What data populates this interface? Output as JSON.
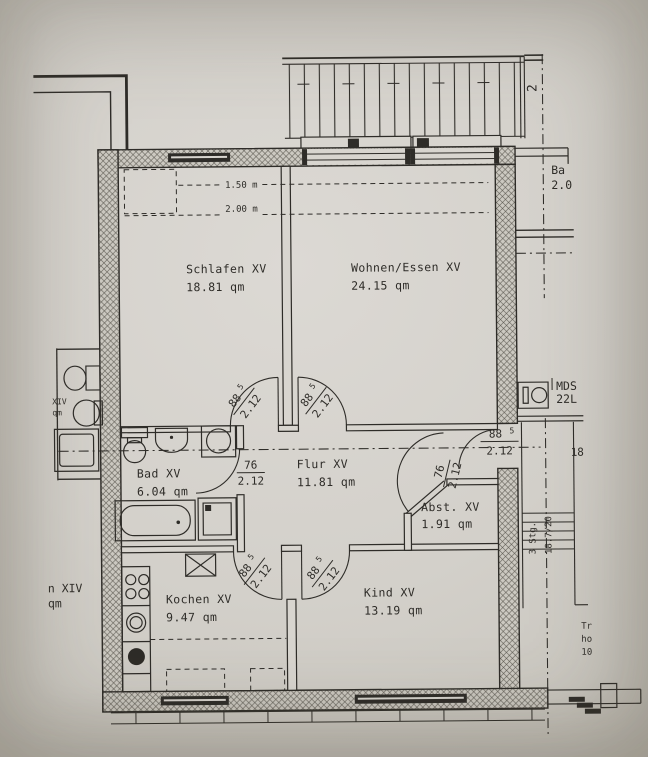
{
  "plan": {
    "rooms": [
      {
        "name": "Schlafen XV",
        "area": "18.81 qm"
      },
      {
        "name": "Wohnen/Essen XV",
        "area": "24.15 qm"
      },
      {
        "name": "Bad XV",
        "area": "6.04 qm"
      },
      {
        "name": "Flur XV",
        "area": "11.81 qm"
      },
      {
        "name": "Abst. XV",
        "area": "1.91 qm"
      },
      {
        "name": "Kochen XV",
        "area": "9.47 qm"
      },
      {
        "name": "Kind XV",
        "area": "13.19 qm"
      }
    ],
    "doors": {
      "d885": {
        "w": "88",
        "sup": "5",
        "h": "2.12"
      },
      "d76": {
        "w": "76",
        "h": "2.12"
      }
    },
    "height_lines": [
      "1.50 m",
      "2.00 m"
    ],
    "annotations": {
      "mds1": "MDS",
      "mds2": "22L",
      "axis": "2",
      "balc1": "Ba",
      "balc2": "2.0",
      "stairs1": "3 Stg.",
      "stairs2": "18.7/20",
      "dim18": "18",
      "frag_tr": "Tr",
      "frag_ho": "ho",
      "frag_10": "10",
      "left_top1": "XIV",
      "left_top2": "qm",
      "left_bot1": "n XIV",
      "left_bot2": "qm"
    },
    "colors": {
      "paper": "#d8d5cf",
      "ink": "#2e2c28",
      "wall_fill": "#ccc9c1"
    }
  }
}
